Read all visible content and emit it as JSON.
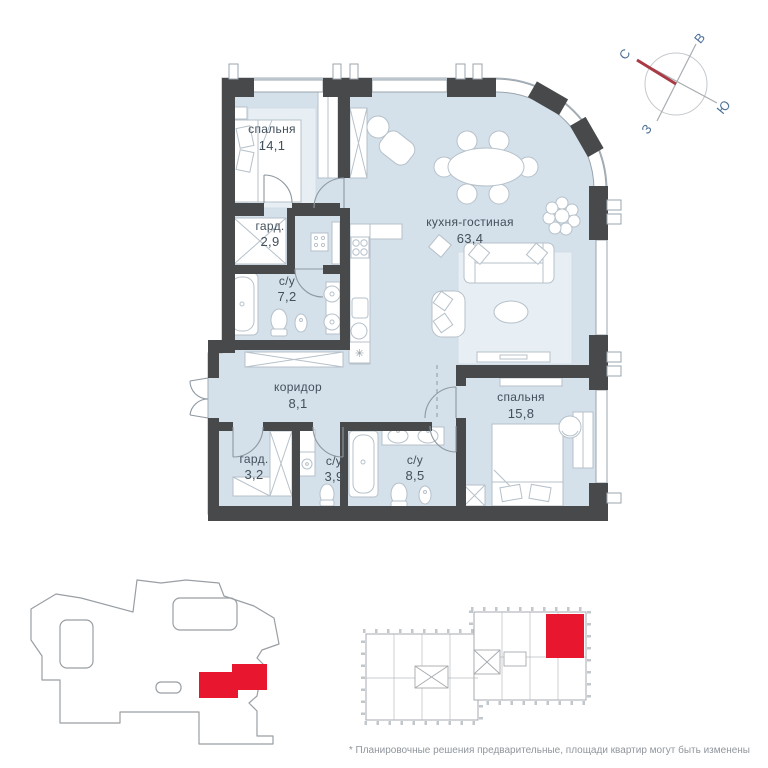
{
  "plan": {
    "rooms": [
      {
        "id": "bedroom-1",
        "name": "спальня",
        "area": "14,1"
      },
      {
        "id": "wardrobe-1",
        "name": "гард.",
        "area": "2,9"
      },
      {
        "id": "bath-1",
        "name": "с/у",
        "area": "7,2"
      },
      {
        "id": "kitchen-living",
        "name": "кухня-гостиная",
        "area": "63,4"
      },
      {
        "id": "corridor",
        "name": "коридор",
        "area": "8,1"
      },
      {
        "id": "wardrobe-2",
        "name": "гард.",
        "area": "3,2"
      },
      {
        "id": "bath-2",
        "name": "с/у",
        "area": "3,9"
      },
      {
        "id": "bath-3",
        "name": "с/у",
        "area": "8,5"
      },
      {
        "id": "bedroom-2",
        "name": "спальня",
        "area": "15,8"
      }
    ],
    "compass": {
      "north": "С",
      "east": "В",
      "south": "Ю",
      "west": "З"
    },
    "footer_note": "* Планировочные решения предварительные, площади квартир могут быть изменены",
    "colors": {
      "floor": "#d4e0ea",
      "walls": "#47494b",
      "highlight": "#e8172f",
      "furniture_stroke": "#b6c1ca",
      "lines": "#9aa4ac",
      "label_text": "#42505c",
      "compass_text": "#4d7198"
    }
  }
}
